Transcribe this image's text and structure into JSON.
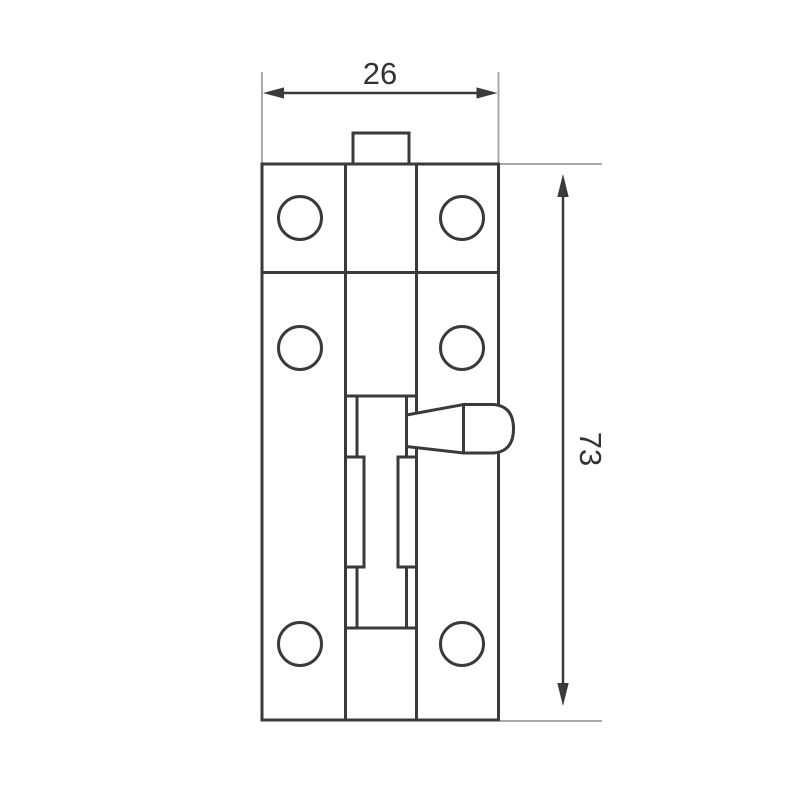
{
  "drawing": {
    "kind": "technical-dimension-drawing",
    "dimensions": {
      "width": {
        "label": "26",
        "value": 26
      },
      "height": {
        "label": "73",
        "value": 73
      }
    },
    "colors": {
      "line": "#3a3a3c",
      "extension_line": "#a9a9a9",
      "label_text": "#333335",
      "background": "#ffffff"
    }
  }
}
